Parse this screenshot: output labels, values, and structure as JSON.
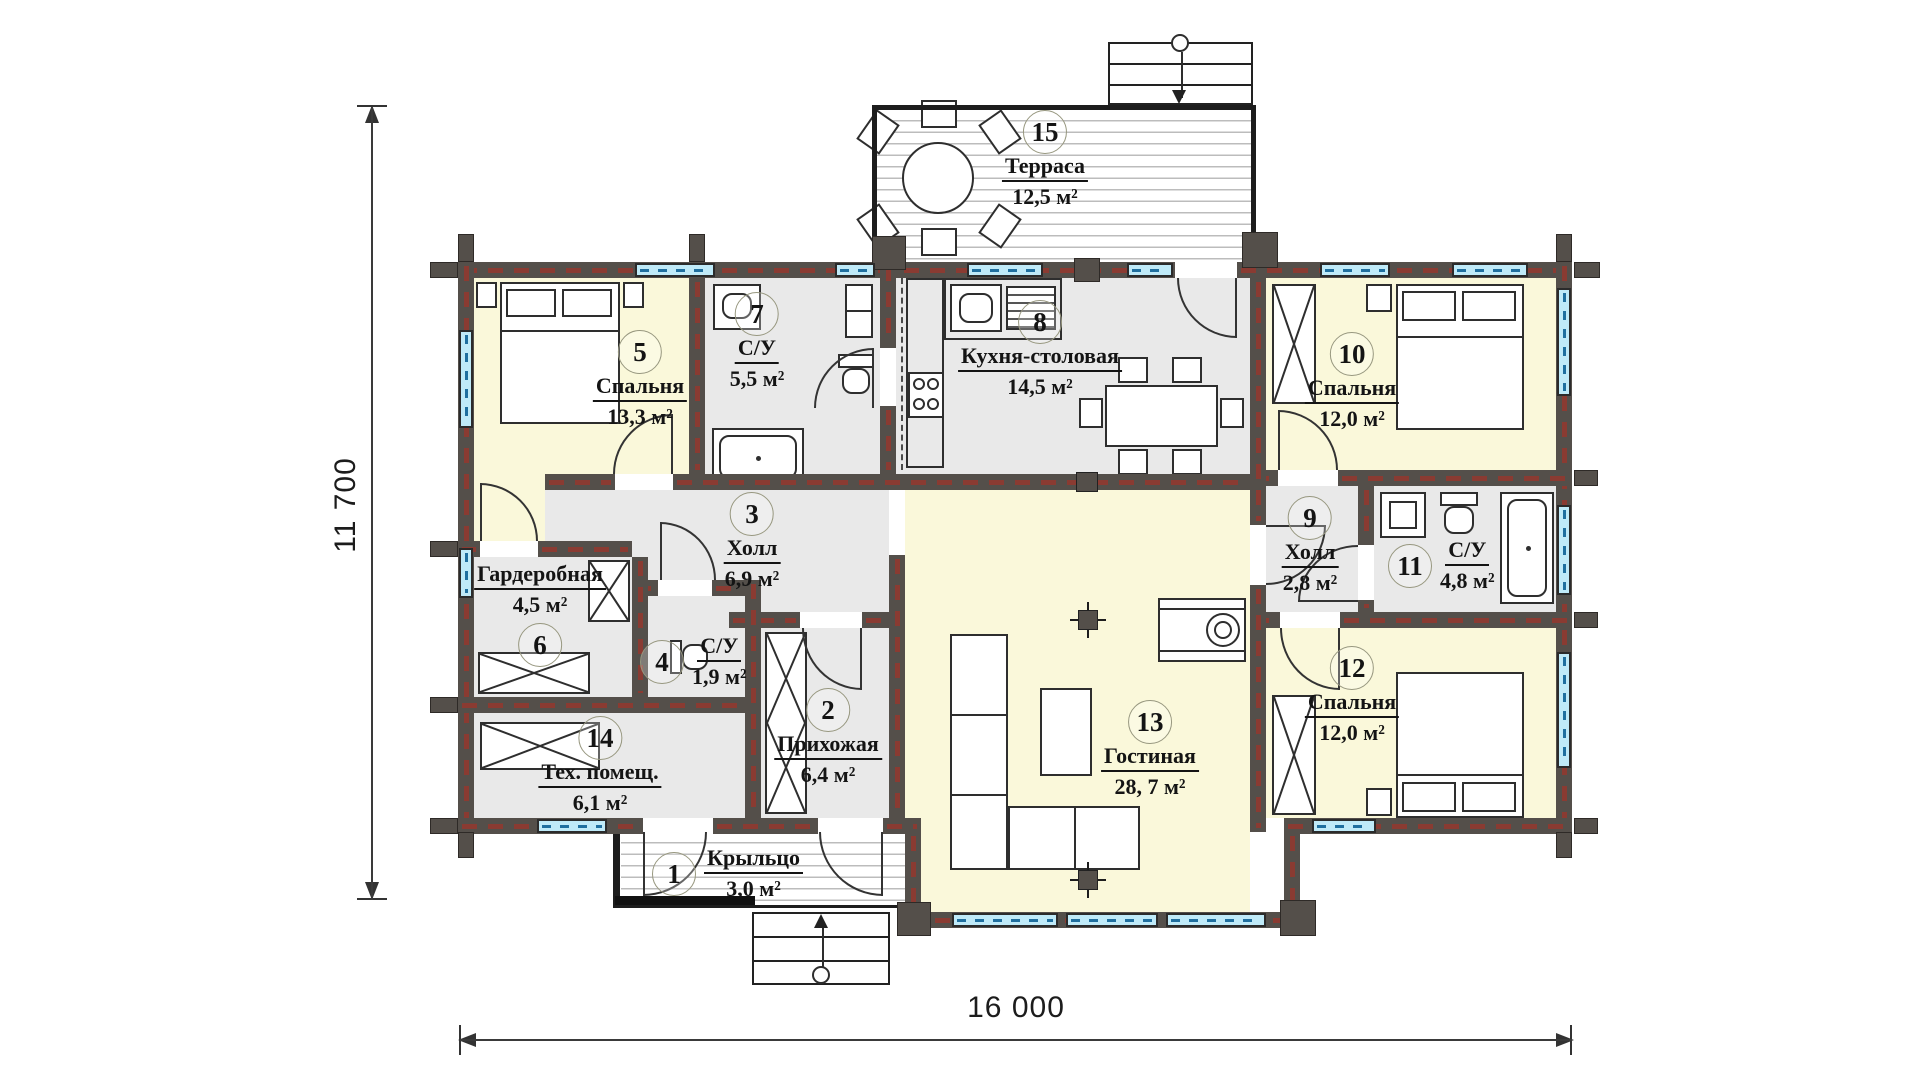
{
  "plan": {
    "type": "floor-plan",
    "dimensions": {
      "vertical": "11 700",
      "horizontal": "16 000"
    },
    "rooms": [
      {
        "number": "1",
        "name": "Крыльцо",
        "area": "3,0 м²"
      },
      {
        "number": "2",
        "name": "Прихожая",
        "area": "6,4 м²"
      },
      {
        "number": "3",
        "name": "Холл",
        "area": "6,9 м²"
      },
      {
        "number": "4",
        "name": "С/У",
        "area": "1,9 м²"
      },
      {
        "number": "5",
        "name": "Спальня",
        "area": "13,3 м²"
      },
      {
        "number": "6",
        "name": "Гардеробная",
        "area": "4,5 м²"
      },
      {
        "number": "7",
        "name": "С/У",
        "area": "5,5 м²"
      },
      {
        "number": "8",
        "name": "Кухня-столовая",
        "area": "14,5 м²"
      },
      {
        "number": "9",
        "name": "Холл",
        "area": "2,8 м²"
      },
      {
        "number": "10",
        "name": "Спальня",
        "area": "12,0 м²"
      },
      {
        "number": "11",
        "name": "С/У",
        "area": "4,8 м²"
      },
      {
        "number": "12",
        "name": "Спальня",
        "area": "12,0 м²"
      },
      {
        "number": "13",
        "name": "Гостиная",
        "area": "28, 7 м²"
      },
      {
        "number": "14",
        "name": "Тех. помещ.",
        "area": "6,1 м²"
      },
      {
        "number": "15",
        "name": "Терраса",
        "area": "12,5 м²"
      }
    ],
    "colors": {
      "wall": "#544f4a",
      "wall_dash": "#8a3b32",
      "room_warm": "#faf8da",
      "room_service": "#e9e9e9",
      "window": "#bfeaf8",
      "window_dash": "#1f6f9f"
    }
  }
}
